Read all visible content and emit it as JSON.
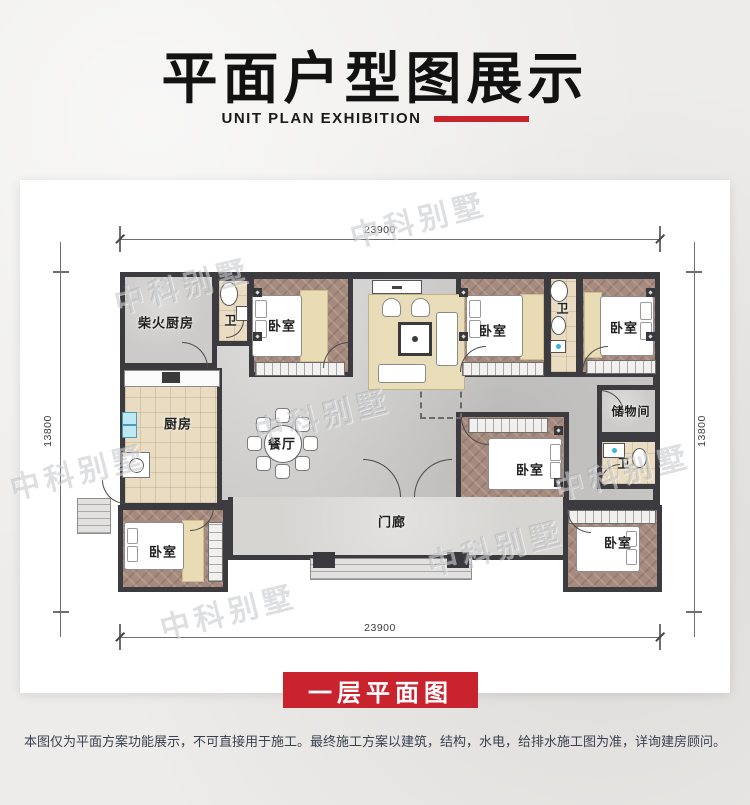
{
  "header": {
    "title": "平面户型图展示",
    "subtitle": "UNIT PLAN EXHIBITION"
  },
  "plan": {
    "watermark": "中科别墅",
    "dims": {
      "top": "23900",
      "bottom": "23900",
      "left": "13800",
      "right": "13800"
    },
    "labels": {
      "firewood_kitchen": "柴火厨房",
      "bath_top_left": "卫",
      "bedroom_top_left": "卧室",
      "bedroom_top_mid": "卧室",
      "bath_top_mid": "卫",
      "bedroom_top_right": "卧室",
      "kitchen": "厨房",
      "dining": "餐厅",
      "bedroom_mid_right": "卧室",
      "storage": "储物间",
      "bath_mid_right": "卫",
      "bedroom_bottom_left": "卧室",
      "porch": "门廊",
      "bedroom_bottom_right": "卧室"
    }
  },
  "footer": {
    "floor_label": "一层平面图",
    "disclaimer": "本图仅为平面方案功能展示，不可直接用于施工。最终施工方案以建筑，结构，水电，给排水施工图为准，详询建房顾问。"
  },
  "colors": {
    "accent": "#c9242e",
    "wall": "#3c3b3f",
    "title": "#121212"
  }
}
